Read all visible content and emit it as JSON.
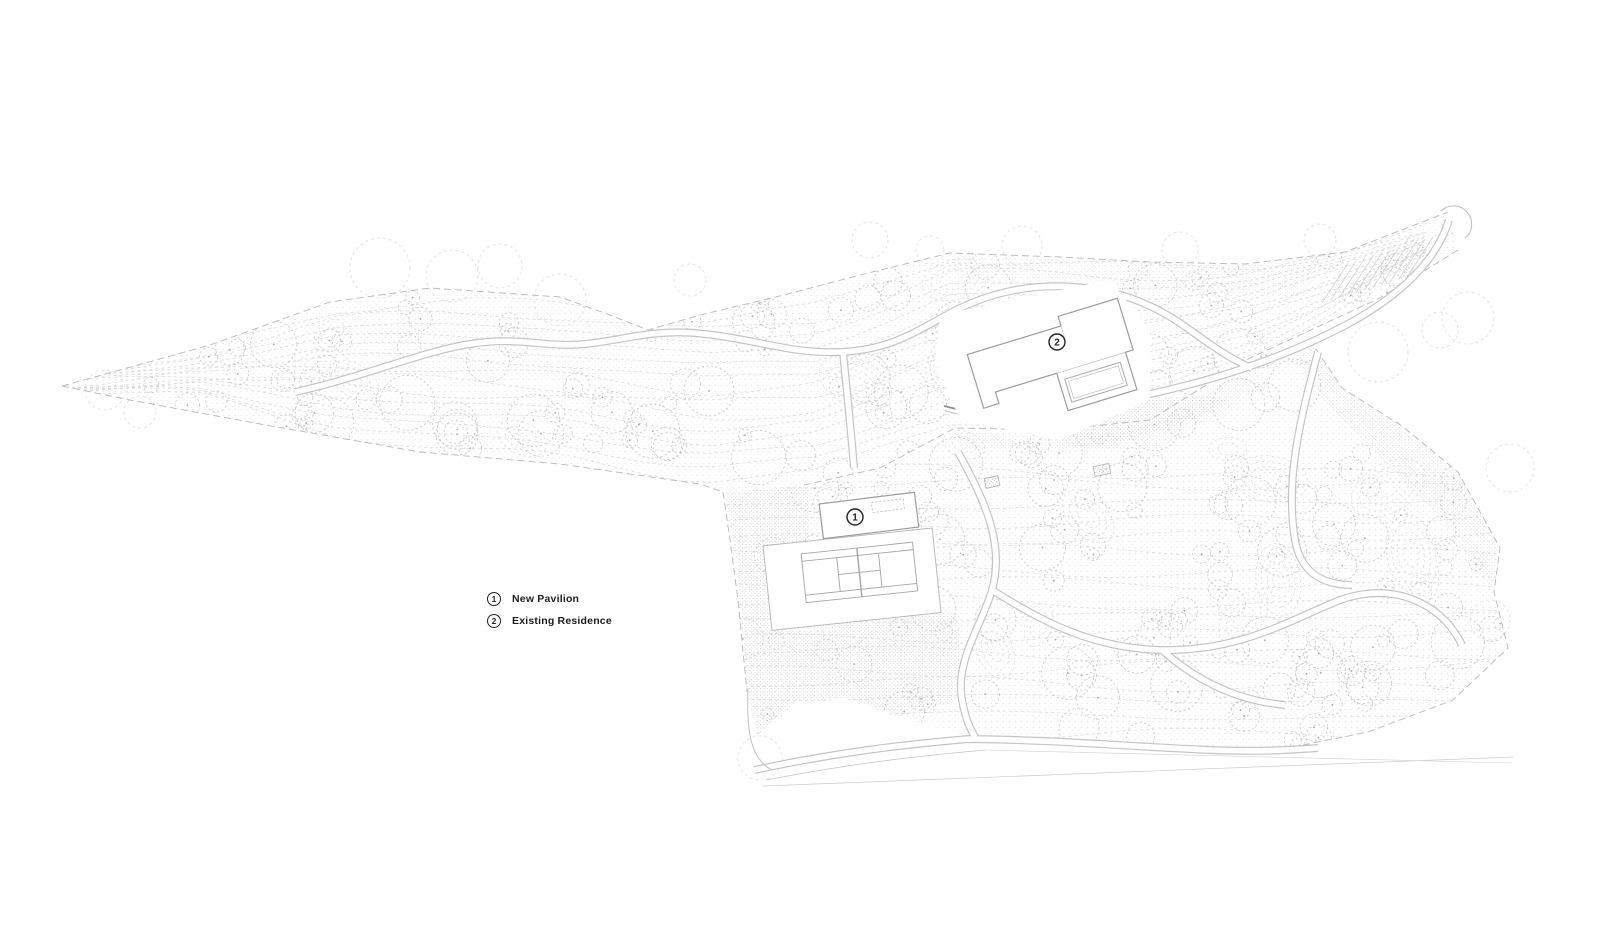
{
  "drawing": {
    "kind": "architectural landscape site plan",
    "colors": {
      "paper": "#ffffff",
      "ink": "#222222",
      "line_light": "#c8c8c8",
      "line_mid": "#a8a8a8",
      "line_faint": "#dedede",
      "building_stroke": "#9c9c9c"
    }
  },
  "legend": {
    "items": [
      {
        "number": "1",
        "label": "New Pavilion"
      },
      {
        "number": "2",
        "label": "Existing Residence"
      }
    ]
  },
  "markers": [
    {
      "number": "1"
    },
    {
      "number": "2"
    }
  ]
}
